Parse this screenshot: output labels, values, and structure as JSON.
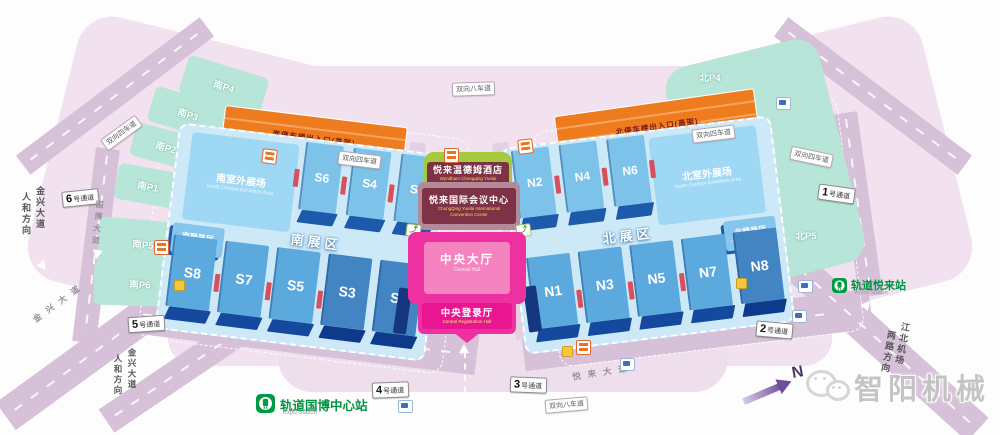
{
  "center": {
    "hotel_zh": "悦来温德姆酒店",
    "hotel_en": "Wyndham Chongqing Yuelai",
    "conv_zh": "悦来国际会议中心",
    "conv_en1": "ChongQing Yuelai International",
    "conv_en2": "Convention Center",
    "hall_zh": "中央大厅",
    "hall_en": "Central Hall",
    "reg_zh": "中央登录厅",
    "reg_en": "Central Registration Hall"
  },
  "south": {
    "zone": "南展区",
    "outdoor_zh": "南室外展场",
    "outdoor_en": "South Outdoor Exhibition Area",
    "reg_zh": "南登录厅",
    "reg_en": "South Registration Hall",
    "ramp": "南停车楼出入口(高架)",
    "halls_top": [
      "S6",
      "S4",
      "S2"
    ],
    "halls_bottom": [
      "S8",
      "S7",
      "S5",
      "S3",
      "S1"
    ],
    "parking": [
      "南P4",
      "南P3",
      "南P2",
      "南P1",
      "南P5",
      "南P6"
    ]
  },
  "north": {
    "zone": "北展区",
    "outdoor_zh": "北室外展场",
    "outdoor_en": "North Outdoor Exhibition Area",
    "reg_zh": "北登录厅",
    "reg_en": "North Registration Hall",
    "ramp": "北停车楼出入口(高架)",
    "halls_top": [
      "N2",
      "N4",
      "N6"
    ],
    "halls_bottom": [
      "N1",
      "N3",
      "N5",
      "N7",
      "N8"
    ],
    "parking": [
      "北P4",
      "北P3",
      "北P2",
      "北P1",
      "北P5",
      "北P6"
    ]
  },
  "gates": {
    "suffix": "号通道",
    "g1": "1",
    "g2": "2",
    "g3": "3",
    "g4": "4",
    "g5": "5",
    "g6": "6"
  },
  "lanes": {
    "eight": "双向八车道",
    "four": "双向四车道"
  },
  "roads": {
    "jinxing": "金兴大道",
    "renhe": "人和方向",
    "guobo": "国博大道",
    "yuelai": "悦来大道",
    "jiangbei": "江北机场",
    "lianglu": "两路方向"
  },
  "stations": {
    "expo_zh": "轨道国博中心站",
    "expo_en": "Expo Station",
    "yuelai_zh": "轨道悦来站",
    "yuelai_en": "Yuelai Station"
  },
  "compass": {
    "n": "N"
  },
  "watermark": {
    "brand": "智阳机械"
  },
  "icons": {
    "escalator": "⤴"
  }
}
